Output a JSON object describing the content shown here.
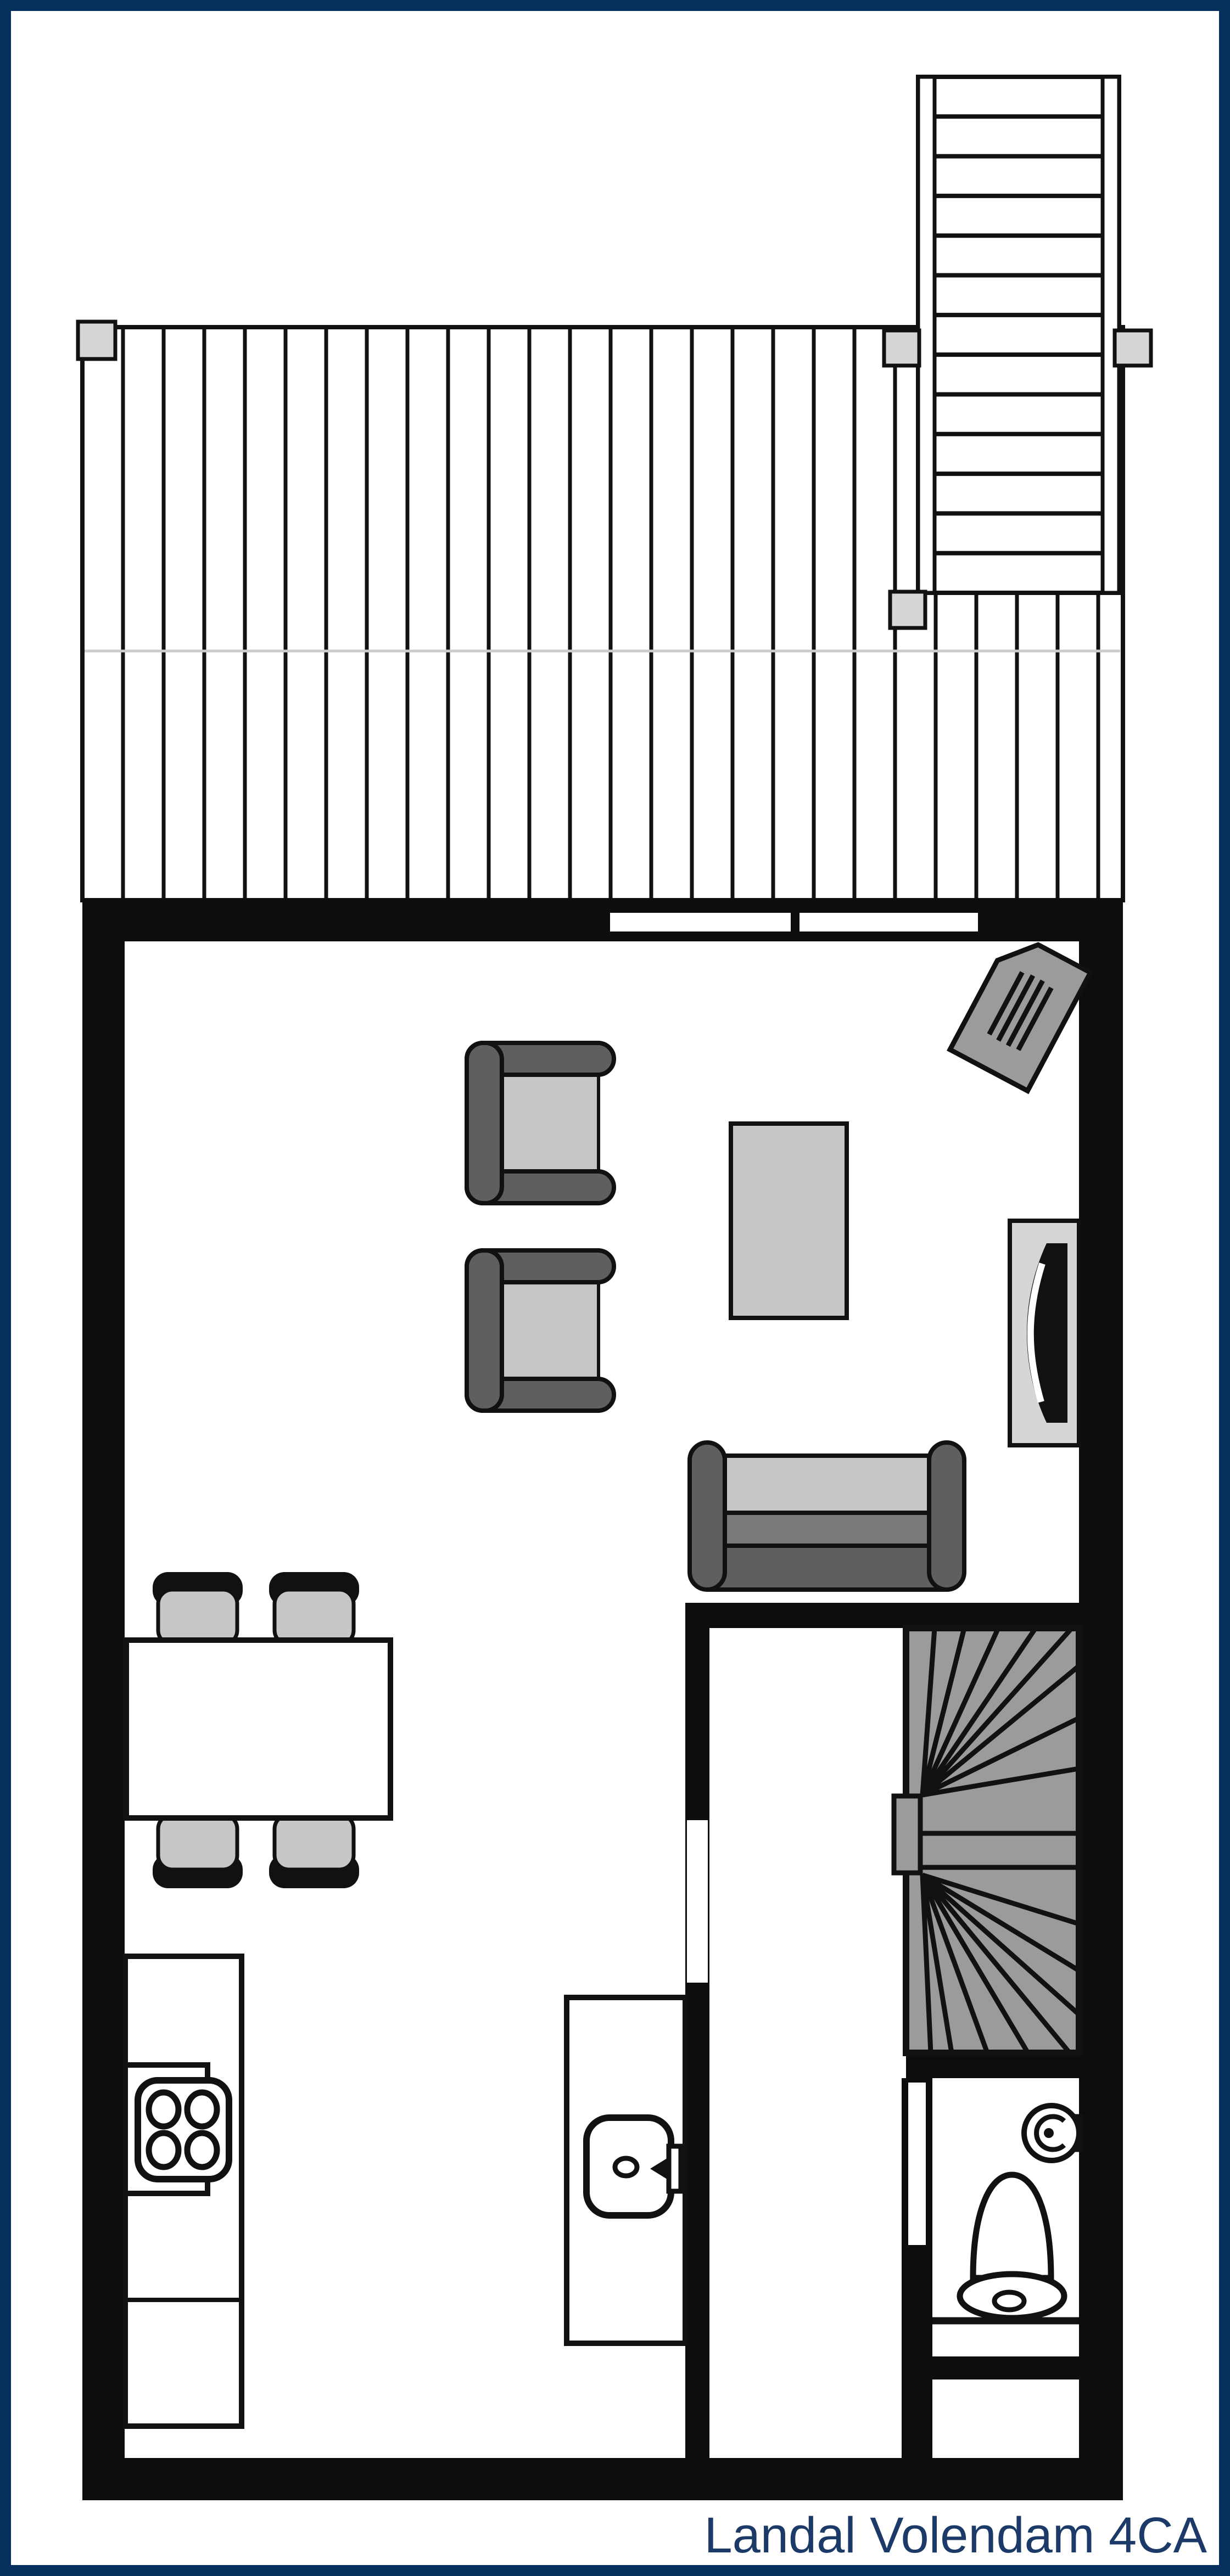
{
  "title": {
    "label": "Landal Volendam 4CA"
  },
  "colors": {
    "border_navy": "#06315f",
    "text_navy": "#1b3a68",
    "wall_black": "#0d0d0d",
    "line_black": "#111111",
    "furniture_dark_gray": "#5f5f5f",
    "sofa_front_gray": "#7a7a7a",
    "stair_gray": "#9b9b9b",
    "cushion_light_gray": "#c6c6c6",
    "cabinet_lighter_gray": "#d6d6d6",
    "deck_seam_gray": "#cccccc",
    "background": "#ffffff"
  }
}
